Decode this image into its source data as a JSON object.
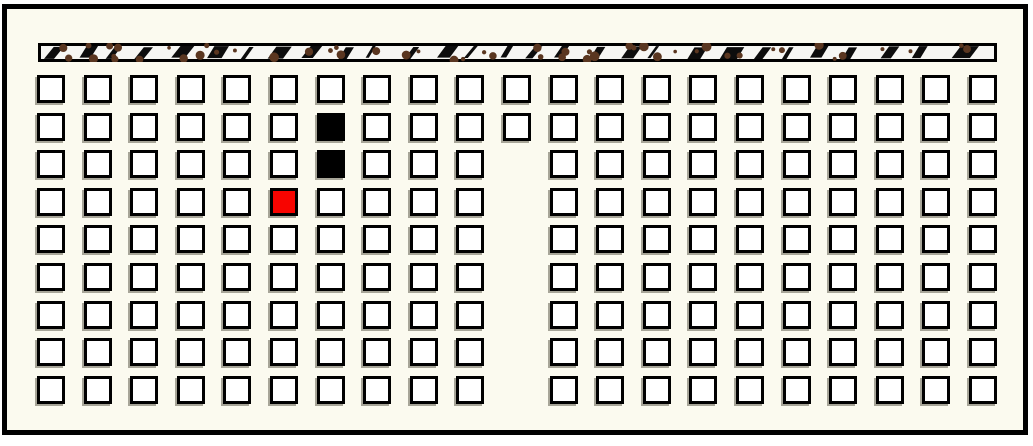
{
  "board": {
    "rows": 9,
    "columns": 21,
    "cells": {
      "black": [
        [
          1,
          6
        ],
        [
          2,
          6
        ]
      ],
      "red": [
        [
          3,
          5
        ]
      ],
      "missing": [
        [
          2,
          10
        ],
        [
          3,
          10
        ],
        [
          4,
          10
        ],
        [
          5,
          10
        ],
        [
          6,
          10
        ],
        [
          7,
          10
        ],
        [
          8,
          10
        ]
      ]
    },
    "counts": {
      "white_cells": 179,
      "black_cells": 2,
      "red_cells": 1
    }
  },
  "colors": {
    "page_background": "#ffffff",
    "board_background": "#fbfaef",
    "frame_border": "#000000",
    "cell_border": "#000000",
    "cell_fill": "#ffffff",
    "cell_black_fill": "#000000",
    "cell_red_fill": "#f80400",
    "cell_shadow": "rgba(99,94,80,0.55)",
    "strip_fill": "#f6f6f3",
    "strip_border": "#000000",
    "strip_mark": "#0d0d0d",
    "strip_dot": "#5a3620"
  }
}
